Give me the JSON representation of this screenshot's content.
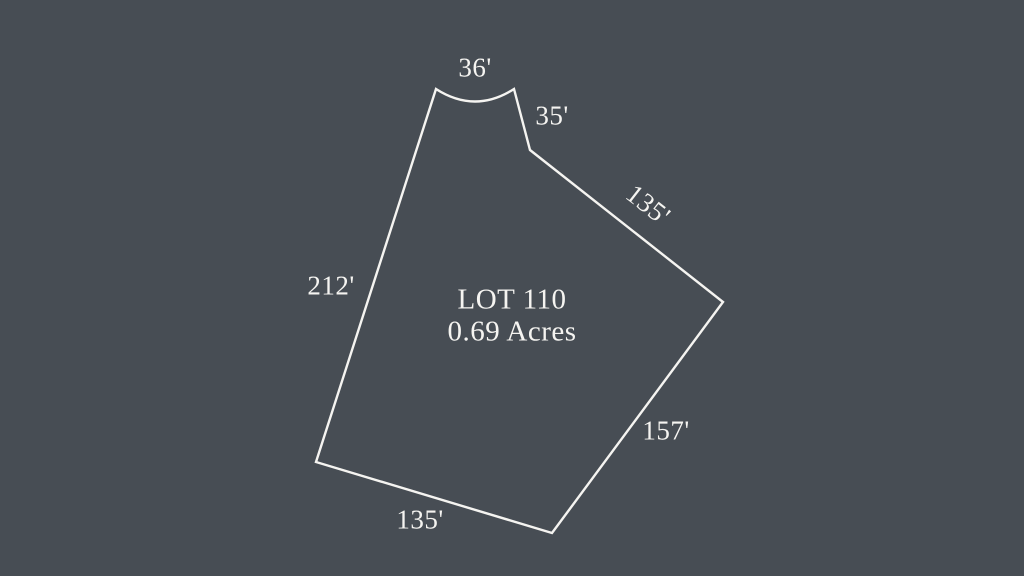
{
  "theme": {
    "background": "#474D54",
    "stroke": "#F5F4F1",
    "text": "#F5F4F1"
  },
  "lot": {
    "title": "LOT 110",
    "area": "0.69 Acres"
  },
  "dimensions": {
    "top": "36'",
    "upper_right": "35'",
    "northeast": "135'",
    "west": "212'",
    "southeast": "157'",
    "south": "135'"
  }
}
